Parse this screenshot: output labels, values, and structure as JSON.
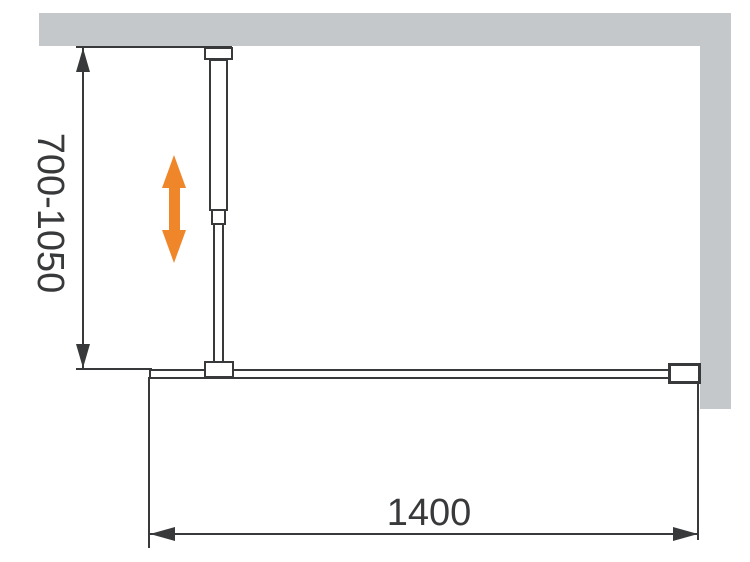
{
  "diagram": {
    "type": "technical-installation-drawing",
    "labels": {
      "height_range": "700-1050",
      "width": "1400"
    },
    "colors": {
      "wall_gray": "#c5c8ca",
      "line_dark": "#38393b",
      "accent_orange": "#f0862a"
    },
    "icons": {
      "adjustability_arrow": "vertical-double-arrow"
    }
  }
}
